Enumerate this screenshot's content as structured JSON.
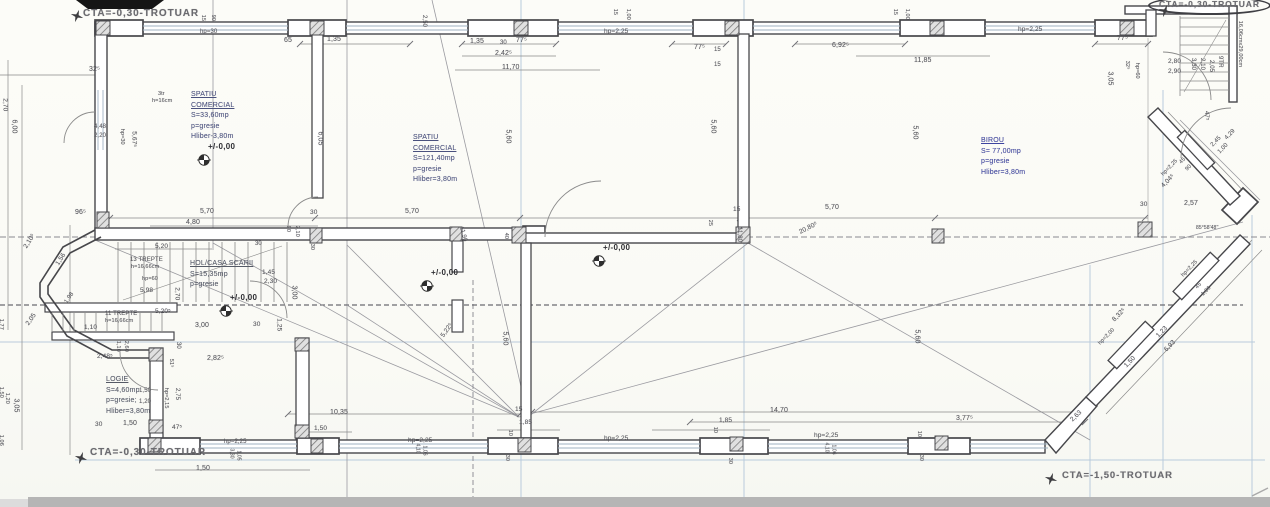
{
  "colors": {
    "wall": "#47474b",
    "construction_blue": "#b9cbdc",
    "dim_text": "#56565c",
    "room_title_blue": "#3d44a0",
    "scan_strip": "#b5b5b5"
  },
  "sidewalk_labels": [
    {
      "t": "CTA=-0,30-TROTUAR",
      "x": 83,
      "y": 8,
      "fs": 10,
      "cls": "cta"
    },
    {
      "t": "CTA=-0,30-TROTUAR",
      "x": 1148,
      "y": -4,
      "fs": 8.5,
      "cls": "cta circled"
    },
    {
      "t": "CTA=-0,30-TROTUAR",
      "x": 90,
      "y": 447,
      "fs": 10,
      "cls": "cta"
    },
    {
      "t": "CTA=-1,50-TROTUAR",
      "x": 1062,
      "y": 471,
      "fs": 9.5,
      "cls": "cta"
    }
  ],
  "rooms": [
    {
      "x": 191,
      "y": 90,
      "c": "#4a517e",
      "title": "SPATIU\nCOMERCIAL",
      "lines": "S=33,60mp\np=gresie\nHliber-3,80m"
    },
    {
      "x": 413,
      "y": 133,
      "c": "#4a517e",
      "title": "SPATIU\nCOMERCIAL",
      "lines": "S=121,40mp\np=gresie\nHliber=3,80m"
    },
    {
      "x": 981,
      "y": 136,
      "c": "#3d44a0",
      "title": "BIROU",
      "lines": "S= 77,00mp\np=gresie\nHliber=3,80m"
    },
    {
      "x": 190,
      "y": 259,
      "c": "#555a66",
      "title": "HOL/CASA SCARII",
      "lines": "S=15,35mp\np=gresie"
    },
    {
      "x": 106,
      "y": 375,
      "c": "#555a66",
      "title": "LOGIE",
      "lines": "S=4,60mp\np=gresie;\nHliber=3,80m"
    }
  ],
  "level_markers": [
    {
      "x": 197,
      "y": 153,
      "label": "+/-0,00"
    },
    {
      "x": 420,
      "y": 279,
      "label": "+/-0,00"
    },
    {
      "x": 592,
      "y": 254,
      "label": "+/-0,00"
    },
    {
      "x": 219,
      "y": 304,
      "label": "+/-0,00"
    }
  ],
  "north_stars": [
    {
      "x": 70,
      "y": 9
    },
    {
      "x": 1158,
      "y": 4
    },
    {
      "x": 74,
      "y": 451
    },
    {
      "x": 1044,
      "y": 472
    }
  ],
  "stair_notes": [
    {
      "t": "13 TREPTE",
      "x": 130,
      "y": 257,
      "fs": 6
    },
    {
      "t": "h=16,66cm",
      "x": 131,
      "y": 265,
      "fs": 5.5
    },
    {
      "t": "hp=60",
      "x": 142,
      "y": 277,
      "fs": 5.5
    },
    {
      "t": "11 TREPTE",
      "x": 105,
      "y": 311,
      "fs": 6
    },
    {
      "t": "h=16,66cm",
      "x": 105,
      "y": 319,
      "fs": 5.5
    },
    {
      "t": "3tr",
      "x": 158,
      "y": 92,
      "fs": 5.5
    },
    {
      "t": "h=16cm",
      "x": 152,
      "y": 99,
      "fs": 5.5
    },
    {
      "t": "9TR",
      "x": 1220,
      "y": 53,
      "r": 90,
      "fs": 6
    },
    {
      "t": "16,06cmx29,00cm",
      "x": 1239,
      "y": 18,
      "r": 90,
      "fs": 5.5
    }
  ],
  "dim_labels": [
    {
      "t": "hp=30",
      "x": 200,
      "y": 29,
      "fs": 6
    },
    {
      "t": "15",
      "x": 202,
      "y": 12,
      "r": 90,
      "fs": 5.5
    },
    {
      "t": "90",
      "x": 212,
      "y": 12,
      "r": 90,
      "fs": 5.5
    },
    {
      "t": "65",
      "x": 284,
      "y": 37
    },
    {
      "t": "1,35",
      "x": 327,
      "y": 36
    },
    {
      "t": "2,50",
      "x": 424,
      "y": 12,
      "r": 90,
      "fs": 6
    },
    {
      "t": "1,35",
      "x": 470,
      "y": 38
    },
    {
      "t": "30",
      "x": 500,
      "y": 40,
      "fs": 6
    },
    {
      "t": "77⁵",
      "x": 516,
      "y": 37
    },
    {
      "t": "2,42⁵",
      "x": 495,
      "y": 50
    },
    {
      "t": "11,70",
      "x": 502,
      "y": 64
    },
    {
      "t": "hp=2,25",
      "x": 604,
      "y": 29,
      "fs": 6.5
    },
    {
      "t": "15",
      "x": 614,
      "y": 6,
      "r": 90,
      "fs": 5.5
    },
    {
      "t": "1,00",
      "x": 627,
      "y": 6,
      "r": 90,
      "fs": 5.5
    },
    {
      "t": "77⁵",
      "x": 694,
      "y": 44
    },
    {
      "t": "15",
      "x": 714,
      "y": 47,
      "fs": 6
    },
    {
      "t": "15",
      "x": 714,
      "y": 62,
      "fs": 6
    },
    {
      "t": "6,92⁵",
      "x": 832,
      "y": 42
    },
    {
      "t": "15",
      "x": 894,
      "y": 6,
      "r": 90,
      "fs": 5.5
    },
    {
      "t": "1,00",
      "x": 906,
      "y": 6,
      "r": 90,
      "fs": 5.5
    },
    {
      "t": "11,85",
      "x": 914,
      "y": 57
    },
    {
      "t": "hp=2,25",
      "x": 1018,
      "y": 27,
      "fs": 6.5
    },
    {
      "t": "77⁵",
      "x": 1117,
      "y": 35
    },
    {
      "t": "3,05",
      "x": 1110,
      "y": 68,
      "r": 90
    },
    {
      "t": "32⁵",
      "x": 1126,
      "y": 58,
      "r": 90,
      "fs": 5.5
    },
    {
      "t": "hp=60",
      "x": 1136,
      "y": 60,
      "r": 90,
      "fs": 5.5
    },
    {
      "t": "2,80",
      "x": 1168,
      "y": 59,
      "fs": 6.5
    },
    {
      "t": "2,90",
      "x": 1168,
      "y": 69,
      "fs": 6.5
    },
    {
      "t": "3,30",
      "x": 1193,
      "y": 55,
      "r": 90,
      "fs": 6
    },
    {
      "t": "2,10",
      "x": 1202,
      "y": 55,
      "r": 90,
      "fs": 6
    },
    {
      "t": "2,05",
      "x": 1211,
      "y": 57,
      "r": 90,
      "fs": 6
    },
    {
      "t": "47⁵",
      "x": 1206,
      "y": 108,
      "r": 90,
      "fs": 6
    },
    {
      "t": "4,29",
      "x": 1226,
      "y": 136,
      "r": -46,
      "fs": 6
    },
    {
      "t": "2,45",
      "x": 1212,
      "y": 143,
      "r": -46,
      "fs": 6
    },
    {
      "t": "1,00",
      "x": 1219,
      "y": 150,
      "r": -46,
      "fs": 6
    },
    {
      "t": "45",
      "x": 1181,
      "y": 161,
      "r": -46,
      "fs": 5.5
    },
    {
      "t": "90",
      "x": 1187,
      "y": 168,
      "r": -46,
      "fs": 5.5
    },
    {
      "t": "hp=2,25",
      "x": 1163,
      "y": 173,
      "r": -46,
      "fs": 5.5
    },
    {
      "t": "4,04⁵",
      "x": 1163,
      "y": 184,
      "r": -46,
      "fs": 6.5
    },
    {
      "t": "2,57",
      "x": 1184,
      "y": 200
    },
    {
      "t": "30",
      "x": 1140,
      "y": 202,
      "fs": 6.5
    },
    {
      "t": "85°58'48''",
      "x": 1196,
      "y": 226,
      "fs": 5
    },
    {
      "t": "32⁵",
      "x": 89,
      "y": 66
    },
    {
      "t": "2,70",
      "x": 4,
      "y": 95,
      "r": 90,
      "fs": 6.5
    },
    {
      "t": "6,00",
      "x": 14,
      "y": 116,
      "r": 90
    },
    {
      "t": "4,48",
      "x": 94,
      "y": 124,
      "fs": 6
    },
    {
      "t": "2,20",
      "x": 94,
      "y": 133,
      "fs": 6
    },
    {
      "t": "hp=30",
      "x": 121,
      "y": 126,
      "r": 90,
      "fs": 5.5
    },
    {
      "t": "5,67⁵",
      "x": 133,
      "y": 128,
      "r": 90,
      "fs": 6.5
    },
    {
      "t": "96⁵",
      "x": 75,
      "y": 209
    },
    {
      "t": "2,10⁵",
      "x": 26,
      "y": 245,
      "r": -58,
      "fs": 6.5
    },
    {
      "t": "1,56",
      "x": 58,
      "y": 262,
      "r": -58,
      "fs": 6.5
    },
    {
      "t": "1,98",
      "x": 66,
      "y": 300,
      "r": -55,
      "fs": 6
    },
    {
      "t": "2,05",
      "x": 28,
      "y": 322,
      "r": -55,
      "fs": 6.5
    },
    {
      "t": "1,10",
      "x": 84,
      "y": 325,
      "fs": 6.5
    },
    {
      "t": "2,48⁵",
      "x": 97,
      "y": 354,
      "fs": 6.5
    },
    {
      "t": "1,77",
      "x": 0,
      "y": 316,
      "r": 90,
      "fs": 5.5
    },
    {
      "t": "3,05",
      "x": 16,
      "y": 395,
      "r": 90
    },
    {
      "t": "1,50",
      "x": 0,
      "y": 384,
      "r": 90,
      "fs": 5.5
    },
    {
      "t": "1,20",
      "x": 6,
      "y": 390,
      "r": 90,
      "fs": 5.5
    },
    {
      "t": "1,06",
      "x": 0,
      "y": 432,
      "r": 90,
      "fs": 5.5
    },
    {
      "t": "5,20",
      "x": 155,
      "y": 244,
      "fs": 6.5
    },
    {
      "t": "30",
      "x": 255,
      "y": 241,
      "fs": 6
    },
    {
      "t": "5,98",
      "x": 140,
      "y": 288,
      "fs": 6.5
    },
    {
      "t": "2,70",
      "x": 176,
      "y": 284,
      "r": 90,
      "fs": 6.5
    },
    {
      "t": "1,45",
      "x": 262,
      "y": 270,
      "fs": 6.5
    },
    {
      "t": "2,30",
      "x": 264,
      "y": 279,
      "fs": 6.5
    },
    {
      "t": "3,00",
      "x": 294,
      "y": 282,
      "r": 90
    },
    {
      "t": "5,20⁵",
      "x": 155,
      "y": 309,
      "fs": 6.5
    },
    {
      "t": "3,00",
      "x": 195,
      "y": 322
    },
    {
      "t": "30",
      "x": 253,
      "y": 322,
      "fs": 6.5
    },
    {
      "t": "1,25",
      "x": 278,
      "y": 315,
      "r": 90,
      "fs": 6.5
    },
    {
      "t": "1,10",
      "x": 117,
      "y": 338,
      "r": 90,
      "fs": 5.5
    },
    {
      "t": "2,60",
      "x": 125,
      "y": 338,
      "r": 90,
      "fs": 5.5
    },
    {
      "t": "30",
      "x": 178,
      "y": 339,
      "r": 90,
      "fs": 6
    },
    {
      "t": "51⁵",
      "x": 170,
      "y": 356,
      "r": 90,
      "fs": 5.5
    },
    {
      "t": "2,82⁵",
      "x": 207,
      "y": 355
    },
    {
      "t": "hp=2,15",
      "x": 165,
      "y": 385,
      "r": 90,
      "fs": 5.5
    },
    {
      "t": "2,75",
      "x": 177,
      "y": 385,
      "r": 90,
      "fs": 6
    },
    {
      "t": "1,50",
      "x": 139,
      "y": 388,
      "fs": 6
    },
    {
      "t": "1,20",
      "x": 139,
      "y": 399,
      "fs": 6
    },
    {
      "t": "30",
      "x": 95,
      "y": 422,
      "fs": 6.5
    },
    {
      "t": "1,50",
      "x": 123,
      "y": 420
    },
    {
      "t": "47⁵",
      "x": 172,
      "y": 425,
      "fs": 6.5
    },
    {
      "t": "5,70",
      "x": 200,
      "y": 208
    },
    {
      "t": "4,80",
      "x": 186,
      "y": 219
    },
    {
      "t": "30",
      "x": 310,
      "y": 210,
      "fs": 6.5
    },
    {
      "t": "5,70",
      "x": 405,
      "y": 208
    },
    {
      "t": "90",
      "x": 287,
      "y": 223,
      "r": 90,
      "fs": 5.5
    },
    {
      "t": "2,10",
      "x": 296,
      "y": 223,
      "r": 90,
      "fs": 5.5
    },
    {
      "t": "30",
      "x": 311,
      "y": 241,
      "r": 90,
      "fs": 5.5
    },
    {
      "t": "15",
      "x": 733,
      "y": 207,
      "fs": 6.5
    },
    {
      "t": "5,70",
      "x": 825,
      "y": 204
    },
    {
      "t": "25",
      "x": 709,
      "y": 217,
      "r": 90,
      "fs": 5.5
    },
    {
      "t": "11,80",
      "x": 739,
      "y": 224,
      "r": 90,
      "fs": 6
    },
    {
      "t": "20,80⁵",
      "x": 800,
      "y": 230,
      "r": -27,
      "fs": 6.5
    },
    {
      "t": "11,90",
      "x": 461,
      "y": 224,
      "r": 75,
      "fs": 6
    },
    {
      "t": "40",
      "x": 505,
      "y": 230,
      "r": 90,
      "fs": 5.5
    },
    {
      "t": "6,05",
      "x": 320,
      "y": 128,
      "r": 90
    },
    {
      "t": "5,60",
      "x": 508,
      "y": 126,
      "r": 90
    },
    {
      "t": "5,60",
      "x": 713,
      "y": 116,
      "r": 90
    },
    {
      "t": "5,60",
      "x": 915,
      "y": 122,
      "r": 90
    },
    {
      "t": "5,60",
      "x": 505,
      "y": 328,
      "r": 90
    },
    {
      "t": "5,60",
      "x": 917,
      "y": 326,
      "r": 90
    },
    {
      "t": "5,22⁵",
      "x": 443,
      "y": 334,
      "r": -55,
      "fs": 6.5
    },
    {
      "t": "10,35",
      "x": 330,
      "y": 409
    },
    {
      "t": "1,50",
      "x": 314,
      "y": 426,
      "fs": 6.5
    },
    {
      "t": "hp=2,25",
      "x": 408,
      "y": 438,
      "fs": 6.5
    },
    {
      "t": "4,10",
      "x": 417,
      "y": 441,
      "r": 90,
      "fs": 5
    },
    {
      "t": "1,06",
      "x": 424,
      "y": 443,
      "r": 90,
      "fs": 5
    },
    {
      "t": "15",
      "x": 515,
      "y": 407,
      "fs": 6.5
    },
    {
      "t": "1,85",
      "x": 519,
      "y": 420,
      "fs": 6.5
    },
    {
      "t": "10",
      "x": 509,
      "y": 427,
      "r": 90,
      "fs": 5.5
    },
    {
      "t": "30",
      "x": 506,
      "y": 452,
      "r": 90,
      "fs": 5.5
    },
    {
      "t": "hp=2,25",
      "x": 604,
      "y": 436,
      "fs": 6.5
    },
    {
      "t": "14,70",
      "x": 770,
      "y": 407
    },
    {
      "t": "1,85",
      "x": 719,
      "y": 418,
      "fs": 6.5
    },
    {
      "t": "10",
      "x": 714,
      "y": 424,
      "r": 90,
      "fs": 5.5
    },
    {
      "t": "30",
      "x": 729,
      "y": 455,
      "r": 90,
      "fs": 5.5
    },
    {
      "t": "hp=2,25",
      "x": 814,
      "y": 433,
      "fs": 6.5
    },
    {
      "t": "4,10",
      "x": 826,
      "y": 440,
      "r": 90,
      "fs": 5
    },
    {
      "t": "1,06",
      "x": 833,
      "y": 442,
      "r": 90,
      "fs": 5
    },
    {
      "t": "10",
      "x": 918,
      "y": 428,
      "r": 90,
      "fs": 5.5
    },
    {
      "t": "30",
      "x": 920,
      "y": 452,
      "r": 90,
      "fs": 5.5
    },
    {
      "t": "3,77⁵",
      "x": 956,
      "y": 415
    },
    {
      "t": "2,63",
      "x": 1072,
      "y": 418,
      "r": -44,
      "fs": 6.5
    },
    {
      "t": "1,50",
      "x": 196,
      "y": 465
    },
    {
      "t": "hp=2,25",
      "x": 224,
      "y": 439,
      "fs": 6
    },
    {
      "t": "3,30",
      "x": 231,
      "y": 446,
      "r": 90,
      "fs": 5
    },
    {
      "t": "1,05",
      "x": 238,
      "y": 448,
      "r": 90,
      "fs": 5
    },
    {
      "t": "8,32⁵",
      "x": 1114,
      "y": 318,
      "r": -46,
      "fs": 6.5
    },
    {
      "t": "hp=2,00",
      "x": 1100,
      "y": 342,
      "r": -46,
      "fs": 5.5
    },
    {
      "t": "1,23",
      "x": 1158,
      "y": 334,
      "r": -46,
      "fs": 6.5
    },
    {
      "t": "6,93",
      "x": 1166,
      "y": 348,
      "r": -46,
      "fs": 6.5
    },
    {
      "t": "1,50",
      "x": 1126,
      "y": 364,
      "r": -46,
      "fs": 6.5
    },
    {
      "t": "hp=2,25",
      "x": 1183,
      "y": 274,
      "r": -46,
      "fs": 5.5
    },
    {
      "t": "45",
      "x": 1197,
      "y": 286,
      "r": -46,
      "fs": 5.5
    },
    {
      "t": "1,06",
      "x": 1203,
      "y": 293,
      "r": -46,
      "fs": 5.5
    }
  ]
}
